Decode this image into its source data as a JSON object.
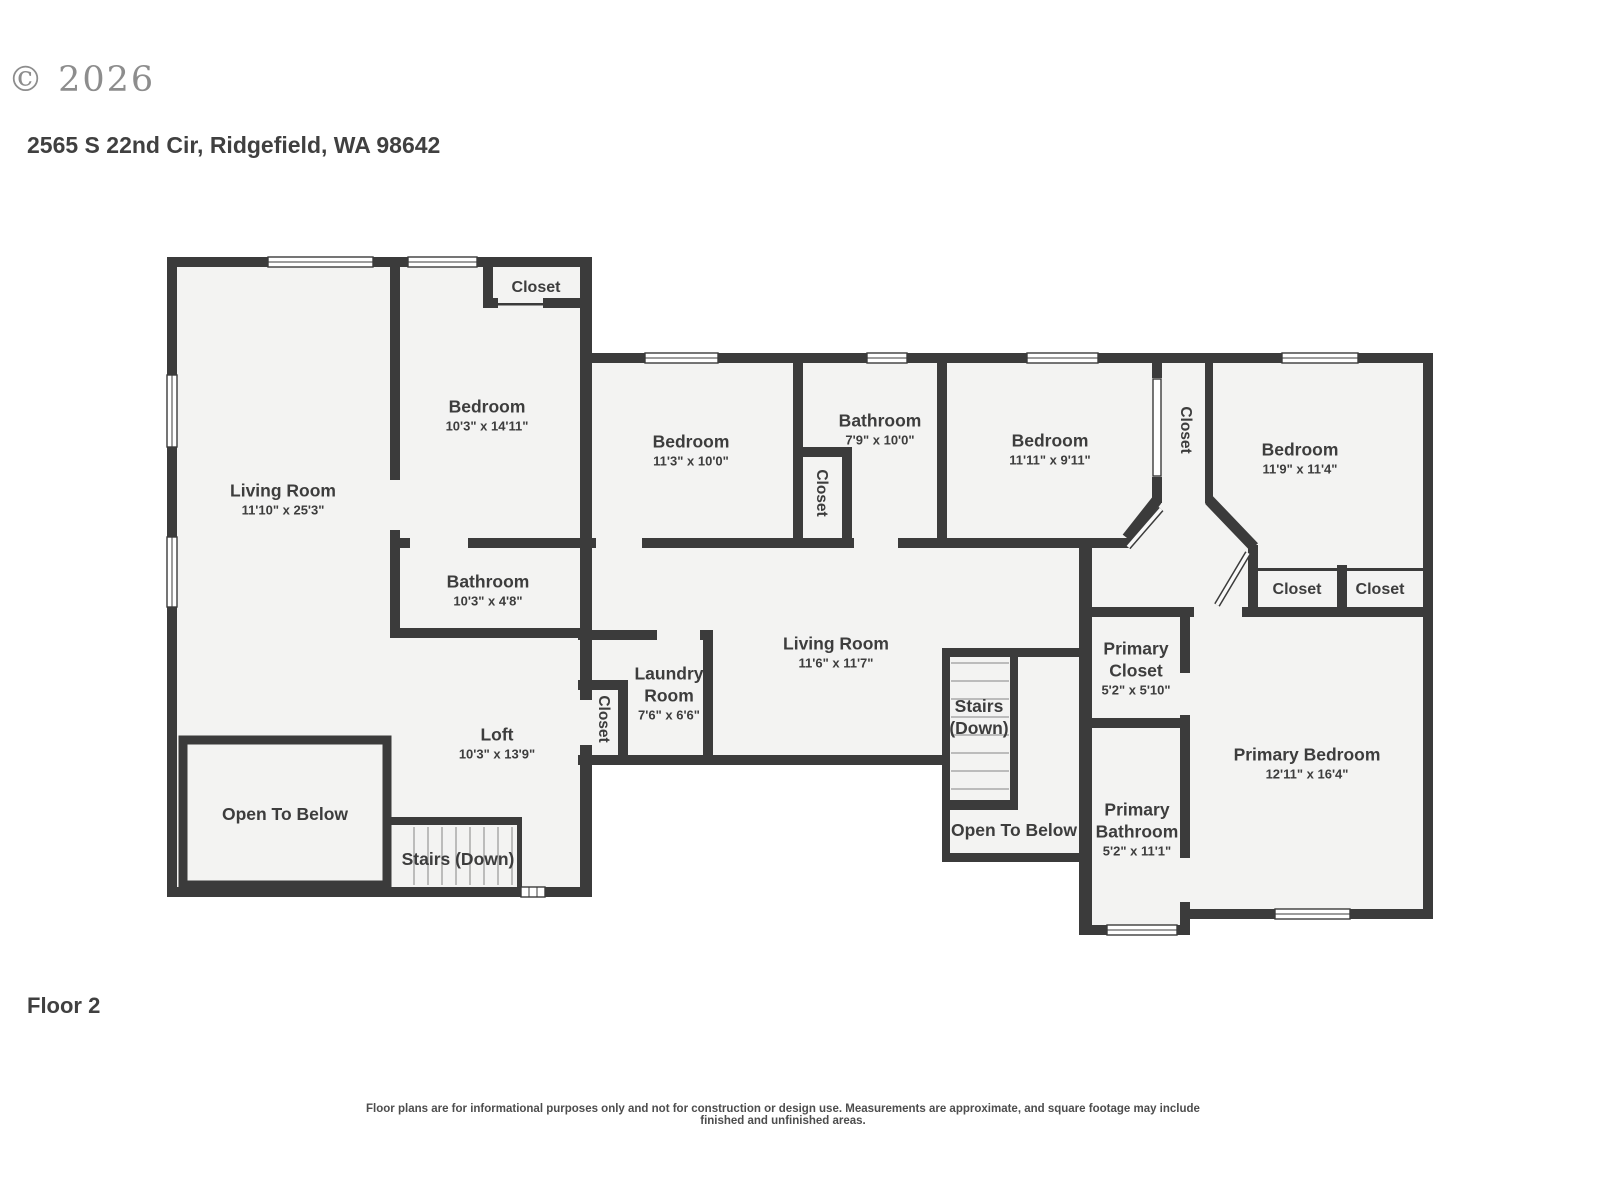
{
  "header": {
    "copyright": "© 2026",
    "address": "2565 S 22nd Cir, Ridgefield, WA 98642"
  },
  "footer": {
    "floor_label": "Floor 2",
    "disclaimer": "Floor plans are for informational purposes only and not for construction or design use. Measurements are approximate, and square footage may include finished and unfinished areas."
  },
  "colors": {
    "wall": "#3b3b3b",
    "floor": "#f3f3f2",
    "text": "#3d3d3d",
    "watermark": "#8d8d8d"
  },
  "rooms": [
    {
      "id": "living-room-1",
      "name": "Living Room",
      "dims": "11'10\" x 25'3\""
    },
    {
      "id": "bedroom-1",
      "name": "Bedroom",
      "dims": "10'3\" x 14'11\""
    },
    {
      "id": "closet-top",
      "name": "Closet",
      "dims": ""
    },
    {
      "id": "bathroom-1",
      "name": "Bathroom",
      "dims": "10'3\" x 4'8\""
    },
    {
      "id": "loft",
      "name": "Loft",
      "dims": "10'3\" x 13'9\""
    },
    {
      "id": "open-below-left",
      "name": "Open To Below",
      "dims": ""
    },
    {
      "id": "stairs-left",
      "name": "Stairs (Down)",
      "dims": ""
    },
    {
      "id": "bedroom-2",
      "name": "Bedroom",
      "dims": "11'3\" x 10'0\""
    },
    {
      "id": "closet-bathroom2",
      "name": "Closet",
      "dims": ""
    },
    {
      "id": "bathroom-2",
      "name": "Bathroom",
      "dims": "7'9\" x 10'0\""
    },
    {
      "id": "bedroom-3",
      "name": "Bedroom",
      "dims": "11'11\" x 9'11\""
    },
    {
      "id": "closet-hall",
      "name": "Closet",
      "dims": ""
    },
    {
      "id": "bedroom-4",
      "name": "Bedroom",
      "dims": "11'9\" x 11'4\""
    },
    {
      "id": "closet-laundry",
      "name": "Closet",
      "dims": ""
    },
    {
      "id": "laundry",
      "name": "Laundry Room",
      "dims": "7'6\" x 6'6\""
    },
    {
      "id": "living-room-2",
      "name": "Living Room",
      "dims": "11'6\" x 11'7\""
    },
    {
      "id": "stairs-center",
      "name": "Stairs (Down)",
      "dims": ""
    },
    {
      "id": "open-below-center",
      "name": "Open To Below",
      "dims": ""
    },
    {
      "id": "closet-a",
      "name": "Closet",
      "dims": ""
    },
    {
      "id": "closet-b",
      "name": "Closet",
      "dims": ""
    },
    {
      "id": "primary-closet",
      "name": "Primary Closet",
      "dims": "5'2\" x 5'10\""
    },
    {
      "id": "primary-bathroom",
      "name": "Primary Bathroom",
      "dims": "5'2\" x 11'1\""
    },
    {
      "id": "primary-bedroom",
      "name": "Primary Bedroom",
      "dims": "12'11\" x 16'4\""
    }
  ]
}
